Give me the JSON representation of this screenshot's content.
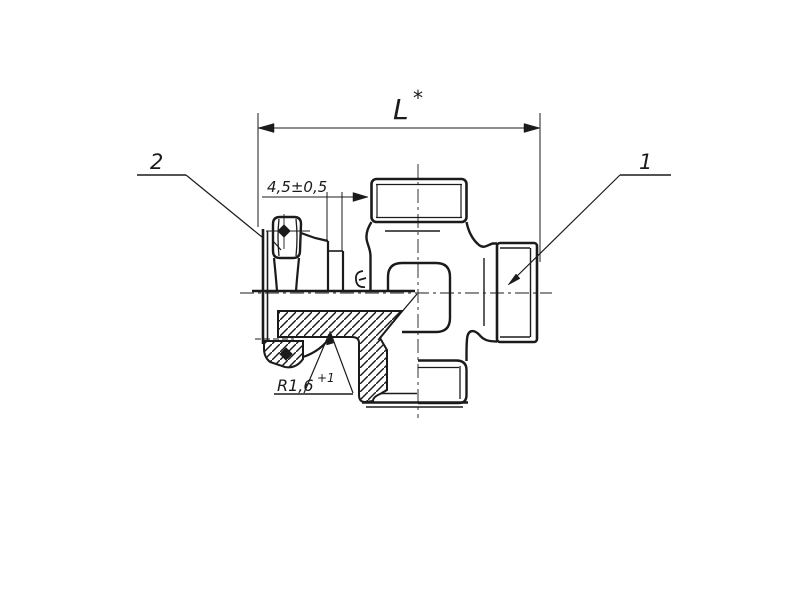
{
  "page": {
    "background": "#ffffff",
    "ink": "#1b1b1b"
  },
  "drawing": {
    "labels": {
      "length_base": "L",
      "length_sup": "*",
      "offset_dim": "4,5±0,5",
      "radius_base": "R1,6",
      "radius_sup": "+1",
      "callout_right": "1",
      "callout_left": "2"
    }
  }
}
